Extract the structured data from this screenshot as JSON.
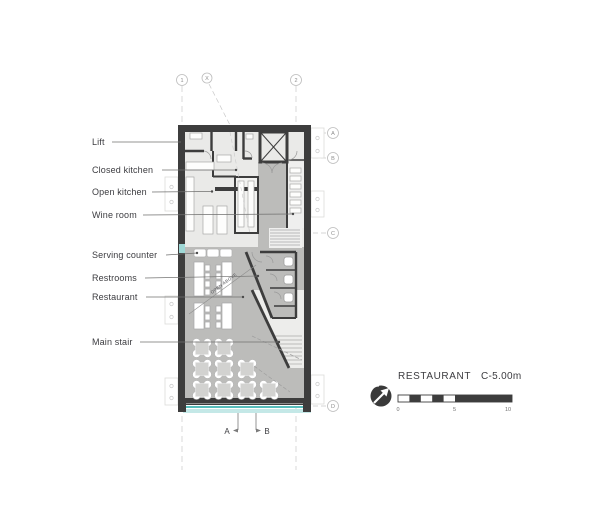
{
  "plan_labels": [
    {
      "text": "Lift"
    },
    {
      "text": "Closed kitchen"
    },
    {
      "text": "Open kitchen"
    },
    {
      "text": "Wine room"
    },
    {
      "text": "Serving counter"
    },
    {
      "text": "Restrooms"
    },
    {
      "text": "Restaurant"
    },
    {
      "text": "Main stair"
    }
  ],
  "annotations": {
    "open_above": "OPEN ABOVE"
  },
  "grid_bubbles": {
    "top": [
      "1",
      "X",
      "2"
    ],
    "right": [
      "A",
      "B",
      "C",
      "D"
    ]
  },
  "section_markers": {
    "left": "A",
    "right": "B"
  },
  "title_block": {
    "name": "RESTAURANT",
    "level": "C-5.00m"
  },
  "scale_bar": {
    "ticks": [
      "0",
      "5",
      "10"
    ]
  },
  "icons": {
    "north_arrow": "north-arrow-icon"
  },
  "colors": {
    "wall": "#3d3d3d",
    "floor_restaurant": "#bcbcba",
    "floor_kitchen": "#eaeae8",
    "floor_stair": "#ededeb",
    "glazing_line": "#57bdbb",
    "glazing_band": "#c4e8e7"
  }
}
